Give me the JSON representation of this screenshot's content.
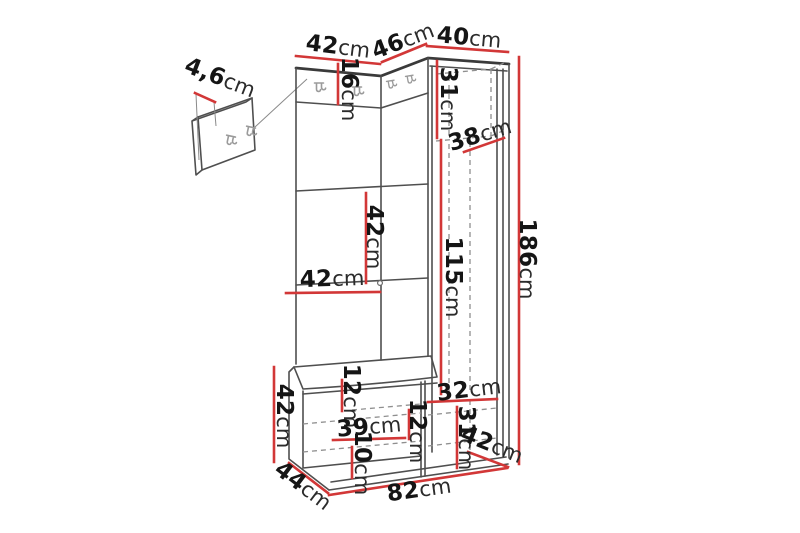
{
  "diagram": {
    "title": "Hallway furniture set dimension diagram",
    "unit": "cm",
    "colors": {
      "background": "#ffffff",
      "outline": "#4f4f4f",
      "dimension_line": "#d23737",
      "text": "#151515"
    }
  },
  "dimensions": {
    "top_left_width": {
      "value": "42",
      "unit": "cm"
    },
    "top_corner_width": {
      "value": "46",
      "unit": "cm"
    },
    "top_right_width": {
      "value": "40",
      "unit": "cm"
    },
    "wall_panel_depth": {
      "value": "4,6",
      "unit": "cm"
    },
    "hook_panel_height": {
      "value": "16",
      "unit": "cm"
    },
    "top_shelf_height": {
      "value": "31",
      "unit": "cm"
    },
    "top_shelf_depth": {
      "value": "38",
      "unit": "cm"
    },
    "left_section_height": {
      "value": "42",
      "unit": "cm"
    },
    "left_panel_width": {
      "value": "42",
      "unit": "cm"
    },
    "hanging_space_height": {
      "value": "115",
      "unit": "cm"
    },
    "total_height": {
      "value": "186",
      "unit": "cm"
    },
    "bench_height": {
      "value": "42",
      "unit": "cm"
    },
    "bench_top_section": {
      "value": "12",
      "unit": "cm"
    },
    "bench_shelf_width": {
      "value": "39",
      "unit": "cm"
    },
    "bench_mid_section": {
      "value": "12",
      "unit": "cm"
    },
    "bench_bottom_section": {
      "value": "10",
      "unit": "cm"
    },
    "lower_shelf_width": {
      "value": "32",
      "unit": "cm"
    },
    "lower_section_height": {
      "value": "31",
      "unit": "cm"
    },
    "cabinet_depth": {
      "value": "42",
      "unit": "cm"
    },
    "bench_depth": {
      "value": "44",
      "unit": "cm"
    },
    "total_width": {
      "value": "82",
      "unit": "cm"
    }
  }
}
